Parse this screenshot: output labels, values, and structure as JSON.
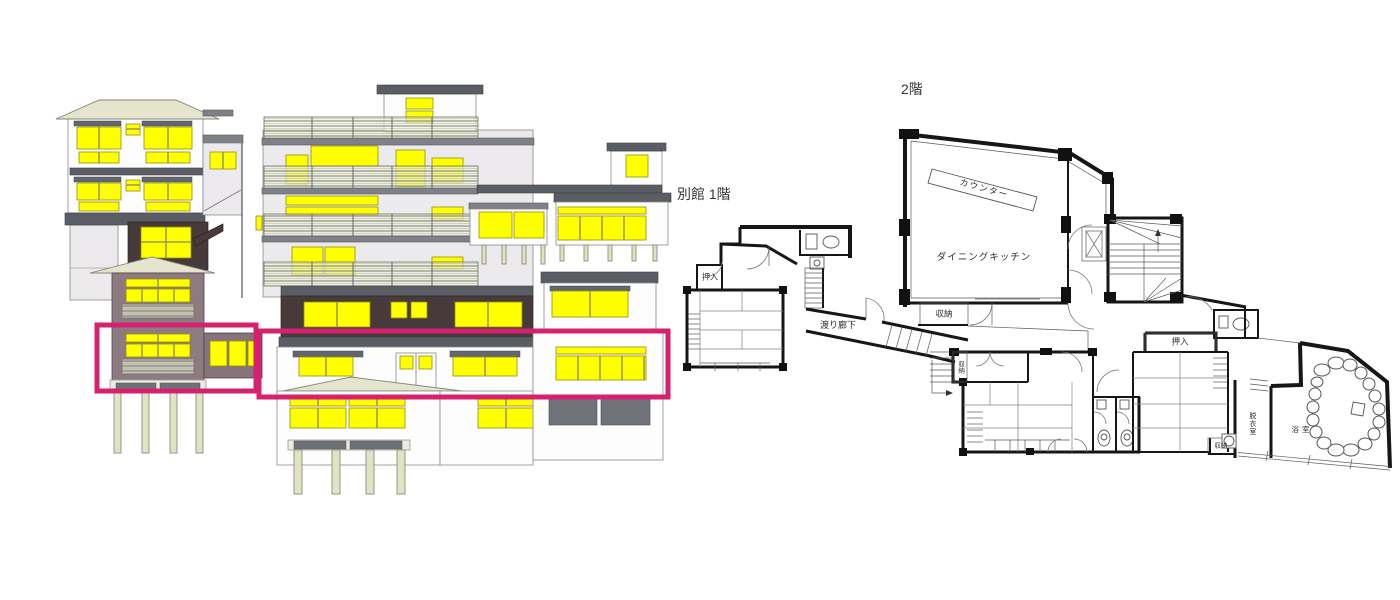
{
  "canvas": {
    "width": 1400,
    "height": 600,
    "background": "#ffffff"
  },
  "colors": {
    "highlight_magenta": "#d4226f",
    "window_yellow": "#ffff00",
    "roof_pale_green": "#e4e5cc",
    "band_dark_gray": "#63666c",
    "wall_dark_brown": "#463a3b",
    "wall_mauve": "#8d7b81",
    "plan_wall_black": "#161616"
  },
  "elevation": {
    "description": "hotel building elevation with yellow-lit windows",
    "highlight_boxes": [
      {
        "x": 97,
        "y": 325,
        "w": 159,
        "h": 66
      },
      {
        "x": 259,
        "y": 331,
        "w": 409,
        "h": 66
      }
    ]
  },
  "floor_plan": {
    "labels": {
      "floor2_title": "2階",
      "annex_title": "別館 1階",
      "counter": "カウンター",
      "dining_kitchen": "ダイニングキッチン",
      "storage_dining": "収納",
      "crossing_corridor": "渡り廊下",
      "closet_annex": "押入",
      "closet_east": "押入",
      "storage_mid_small": "収納",
      "storage_east_small": "収納",
      "dressing_room": "脱衣室",
      "bathroom": "浴室"
    }
  }
}
